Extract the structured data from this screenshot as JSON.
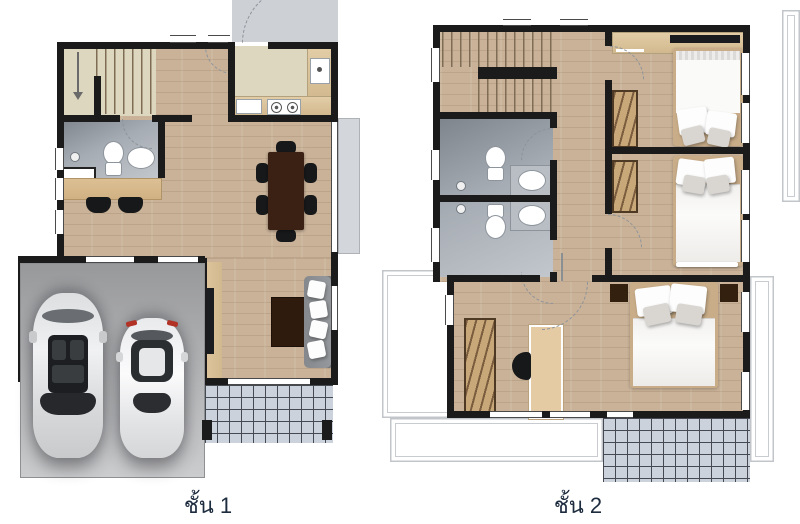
{
  "floors": [
    {
      "id": "floor-1",
      "label": "ชั้น 1"
    },
    {
      "id": "floor-2",
      "label": "ชั้น 2"
    }
  ],
  "palette": {
    "background": "#ffffff",
    "wall": "#1b1b1b",
    "wood_floor": "#c9b298",
    "stair_landing": "#ded7bf",
    "bathroom_floor": "#9ba1a9",
    "garage_floor": "#aeb0b2",
    "patio_tile": "#ccd2db",
    "porch": "#cdd0d5",
    "counter_wood": "#d9c09a",
    "wardrobe_wood": "#a8895f",
    "dark_furniture": "#3a2113",
    "sofa": "#8e9194",
    "bedding": "#fafaf8",
    "label_text": "#1d2b3e"
  }
}
